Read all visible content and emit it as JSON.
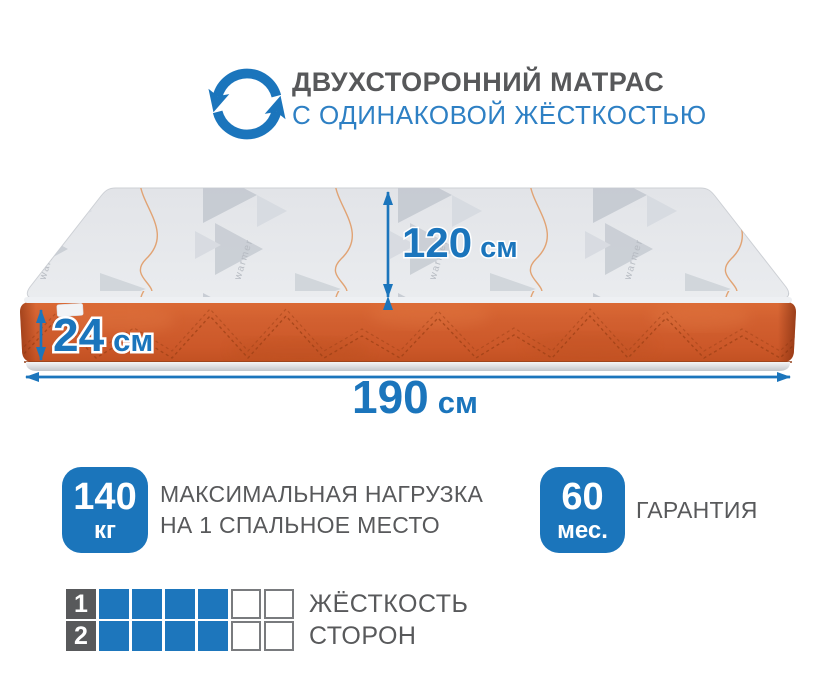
{
  "header": {
    "title": "ДВУХСТОРОННИЙ МАТРАС",
    "subtitle": "С ОДИНАКОВОЙ ЖЁСТКОСТЬЮ",
    "icon": "rotate-arrows-icon"
  },
  "mattress": {
    "fabric_brand": "warmer",
    "dimensions": {
      "depth": {
        "value": "120",
        "unit": "см"
      },
      "height": {
        "value": "24",
        "unit": "см"
      },
      "length": {
        "value": "190",
        "unit": "см"
      }
    }
  },
  "features": [
    {
      "badge_value": "140",
      "badge_unit": "кг",
      "label_line1": "МАКСИМАЛЬНАЯ НАГРУЗКА",
      "label_line2": "НА 1 СПАЛЬНОЕ МЕСТО"
    },
    {
      "badge_value": "60",
      "badge_unit": "мес.",
      "label_line1": "ГАРАНТИЯ",
      "label_line2": ""
    }
  ],
  "hardness_scale": {
    "rows": [
      {
        "number": "1",
        "filled": 4,
        "total": 6,
        "label": "ЖЁСТКОСТЬ"
      },
      {
        "number": "2",
        "filled": 4,
        "total": 6,
        "label": "СТОРОН"
      }
    ]
  },
  "colors": {
    "accent_blue": "#1b75bc",
    "subtitle_blue": "#2e80c4",
    "text_gray": "#58595b",
    "mattress_orange": "#d05d2c"
  }
}
